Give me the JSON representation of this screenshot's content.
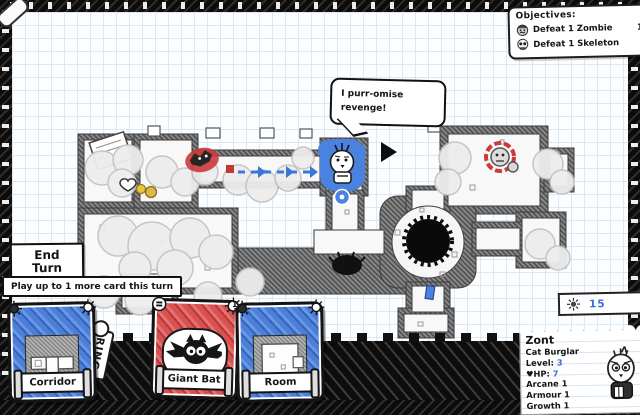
{
  "objectives": {
    "title": "Objectives:",
    "items": [
      {
        "icon": "zombie-icon",
        "label": "Defeat 1 Zombie",
        "count": "1"
      },
      {
        "icon": "skeleton-icon",
        "label": "Defeat 1 Skeleton",
        "count": ""
      }
    ]
  },
  "speech": {
    "line1": "I purr-omise",
    "line2": "revenge!"
  },
  "buttons": {
    "end_turn_line1": "End",
    "end_turn_line2": "Turn"
  },
  "hint": {
    "text": "Play up to 1 more card this turn"
  },
  "hand": {
    "deck_label": "RING",
    "cards": [
      {
        "name": "Corridor",
        "type": "dungeon",
        "cost": ""
      },
      {
        "name": "Giant Bat",
        "type": "monster",
        "cost": "1"
      },
      {
        "name": "Room",
        "type": "dungeon",
        "cost": ""
      }
    ]
  },
  "resources": {
    "gold": "15"
  },
  "character": {
    "name": "Zont",
    "class": "Cat Burglar",
    "level_label": "Level:",
    "level": "3",
    "hp_icon": "♥",
    "hp_label": "HP:",
    "hp": "7",
    "stats": [
      {
        "label": "Arcane",
        "value": "1"
      },
      {
        "label": "Armour",
        "value": "1"
      },
      {
        "label": "Growth",
        "value": "1"
      }
    ]
  },
  "colors": {
    "card_blue": "#4c80d8",
    "card_red": "#d85252",
    "accent_blue": "#3a6fd8",
    "enemy_red": "#cc3a3a",
    "paper_grid": "#dce8f3"
  }
}
